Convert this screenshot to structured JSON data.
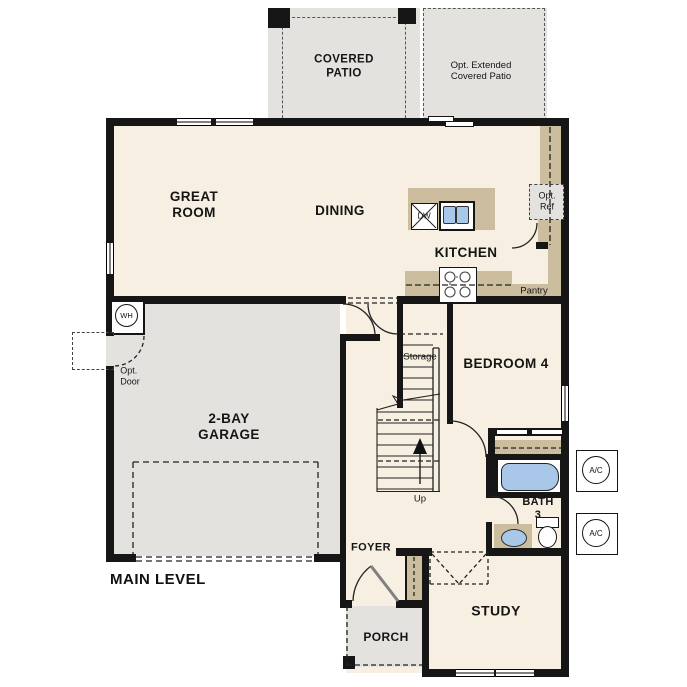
{
  "colors": {
    "wall": "#161616",
    "floor": "#f7efe1",
    "concrete": "#e4e2df",
    "cabinet": "#cbbd9e",
    "water": "#a9c8e9"
  },
  "patio": {
    "covered": "COVERED\nPATIO",
    "extended": "Opt. Extended\nCovered Patio"
  },
  "rooms": {
    "great_room": "GREAT\nROOM",
    "dining": "DINING",
    "kitchen": "KITCHEN",
    "garage": "2-BAY\nGARAGE",
    "bedroom4": "BEDROOM 4",
    "bath": "BATH\n3",
    "study": "STUDY",
    "foyer": "FOYER",
    "porch": "PORCH"
  },
  "features": {
    "pantry": "Pantry",
    "storage": "Storage",
    "up": "Up",
    "wh": "WH",
    "dw": "DW",
    "opt_ref": "Opt.\nRef",
    "opt_door": "Opt.\nDoor",
    "ac_top": "A/C",
    "ac_bottom": "A/C"
  },
  "footer": {
    "level_label": "MAIN LEVEL"
  }
}
